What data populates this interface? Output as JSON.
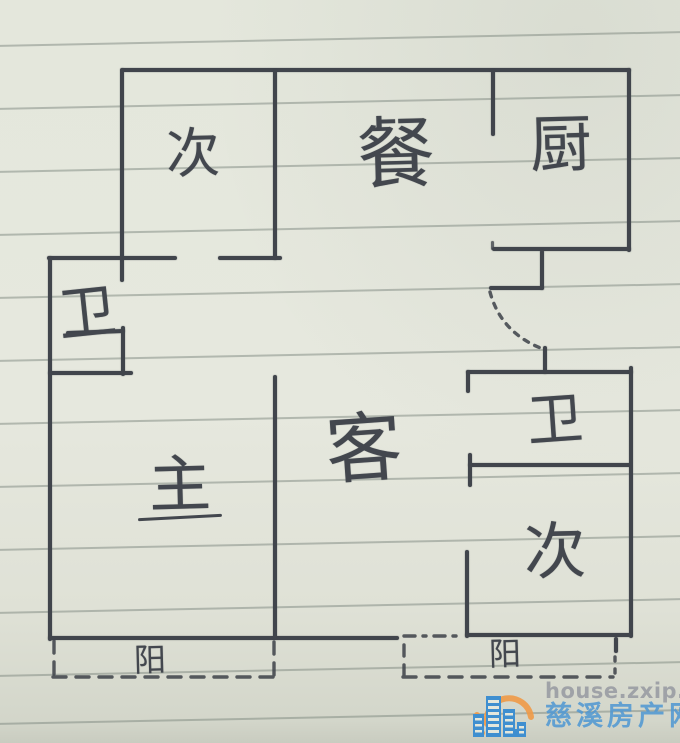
{
  "page": {
    "kind": "hand-drawn floor plan sketch on ruled notebook paper",
    "width": 680,
    "height": 743
  },
  "palette": {
    "paper": "#e4e7dc",
    "ink": "#41454c",
    "ruled_line": "#7a847c",
    "watermark_gray": "#9b9ea4",
    "watermark_blue": "#4e97d3",
    "logo_orange": "#ef9a47",
    "logo_blue": "#3f8fd0"
  },
  "floorplan": {
    "rooms": [
      {
        "name": "bedroom-top",
        "label": "次"
      },
      {
        "name": "dining-room",
        "label": "餐"
      },
      {
        "name": "kitchen",
        "label": "厨"
      },
      {
        "name": "bathroom-left",
        "label": "卫"
      },
      {
        "name": "living-room",
        "label": "客"
      },
      {
        "name": "master-bedroom",
        "label": "主"
      },
      {
        "name": "bathroom-right",
        "label": "卫"
      },
      {
        "name": "bedroom-bottom",
        "label": "次"
      },
      {
        "name": "balcony-left",
        "label": "阳"
      },
      {
        "name": "balcony-right",
        "label": "阳"
      }
    ]
  },
  "watermark": {
    "url": "house.zxip.com",
    "site_name": "慈溪房产网"
  }
}
